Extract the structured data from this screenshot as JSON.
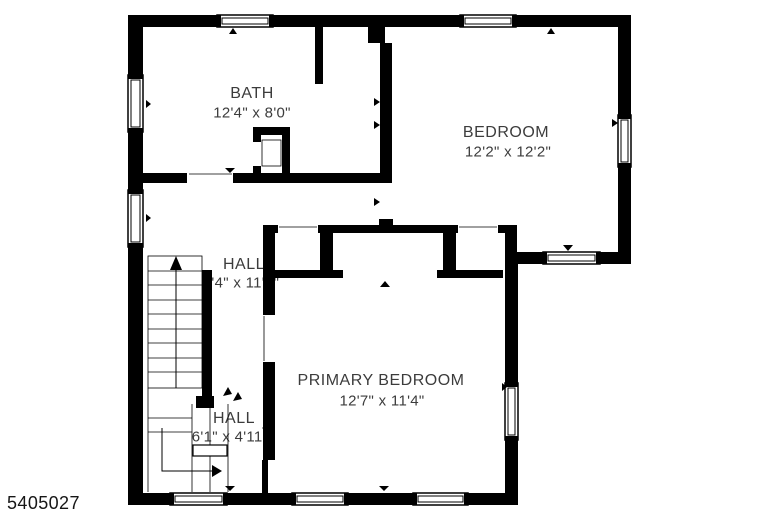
{
  "listing_id": "5405027",
  "rooms": [
    {
      "name": "BATH",
      "dimensions": "12'4\" x 8'0\""
    },
    {
      "name": "BEDROOM",
      "dimensions": "12'2\" x 12'2\""
    },
    {
      "name": "HALL",
      "dimensions": "2'4\" x 11'8\""
    },
    {
      "name": "PRIMARY BEDROOM",
      "dimensions": "12'7\" x 11'4\""
    },
    {
      "name": "HALL",
      "dimensions": "6'1\" x 4'11\""
    }
  ],
  "colors": {
    "wall": "#000000",
    "background": "#ffffff",
    "room_text": "#3c3c3c",
    "id_text": "#161616"
  }
}
